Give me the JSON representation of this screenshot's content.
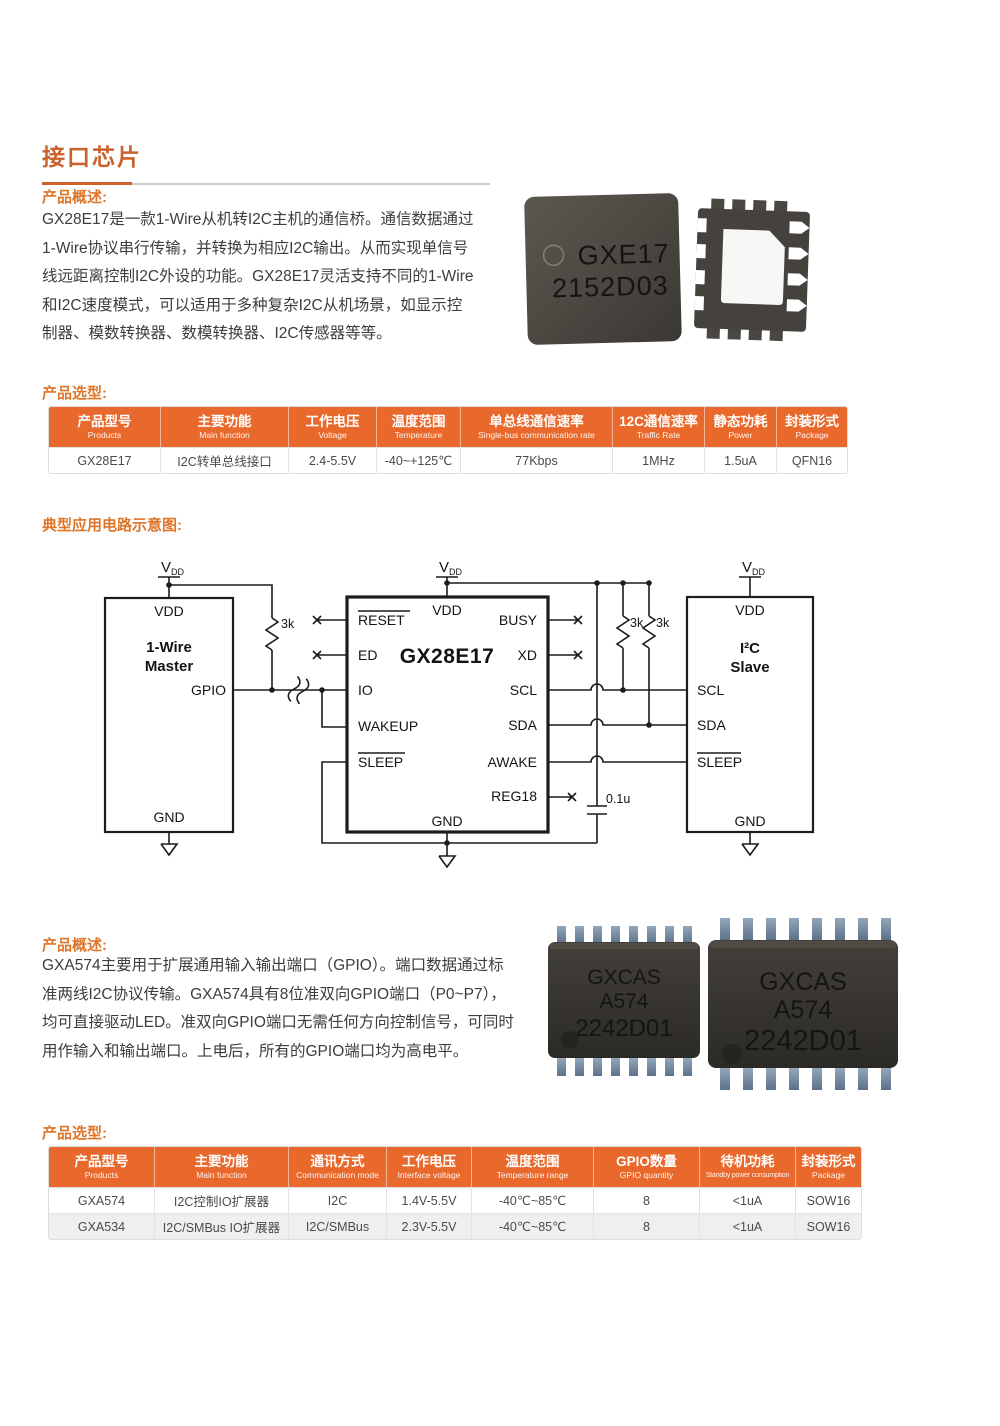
{
  "page": {
    "title": "接口芯片"
  },
  "colors": {
    "accent_orange": "#C9622B",
    "label_orange": "#DE7629",
    "table_header_bg": "#E9682B",
    "alt_row_bg": "#EFEFEF"
  },
  "section1": {
    "overview_label": "产品概述:",
    "overview_text": "GX28E17是一款1-Wire从机转I2C主机的通信桥。通信数据通过\n1-Wire协议串行传输，并转换为相应I2C输出。从而实现单信号\n线远距离控制I2C外设的功能。GX28E17灵活支持不同的1-Wire\n和I2C速度模式，可以适用于多种复杂I2C从机场景，如显示控\n制器、模数转换器、数模转换器、I2C传感器等等。",
    "chip_marking": {
      "line1": "GXE17",
      "line2": "2152D03"
    },
    "selection_label": "产品选型:",
    "table": {
      "columns": [
        {
          "zh": "产品型号",
          "en": "Products"
        },
        {
          "zh": "主要功能",
          "en": "Main function"
        },
        {
          "zh": "工作电压",
          "en": "Voltage"
        },
        {
          "zh": "温度范围",
          "en": "Temperature"
        },
        {
          "zh": "单总线通信速率",
          "en": "Single-bus communication rate"
        },
        {
          "zh": "12C通信速率",
          "en": "Traffic Rate"
        },
        {
          "zh": "静态功耗",
          "en": "Power"
        },
        {
          "zh": "封装形式",
          "en": "Package"
        }
      ],
      "rows": [
        [
          "GX28E17",
          "I2C转单总线接口",
          "2.4-5.5V",
          "-40~+125℃",
          "77Kbps",
          "1MHz",
          "1.5uA",
          "QFN16"
        ]
      ]
    }
  },
  "diagram": {
    "label": "典型应用电路示意图:",
    "supply_v": "V",
    "supply_sub": "DD",
    "master": {
      "name1": "1-Wire",
      "name2": "Master",
      "vdd": "VDD",
      "gpio": "GPIO",
      "gnd": "GND"
    },
    "bridge": {
      "title": "GX28E17",
      "vdd": "VDD",
      "gnd": "GND",
      "reset": "RESET",
      "ed": "ED",
      "io": "IO",
      "wakeup": "WAKEUP",
      "sleep": "SLEEP",
      "busy": "BUSY",
      "xd": "XD",
      "scl": "SCL",
      "sda": "SDA",
      "awake": "AWAKE",
      "reg18": "REG18"
    },
    "slave": {
      "name1": "I²C",
      "name2": "Slave",
      "vdd": "VDD",
      "scl": "SCL",
      "sda": "SDA",
      "sleep": "SLEEP",
      "gnd": "GND"
    },
    "r_pullup_1wire": "3k",
    "r_pullup_scl": "3k",
    "r_pullup_sda": "3k",
    "cap": "0.1u"
  },
  "section2": {
    "overview_label": "产品概述:",
    "overview_text": "GXA574主要用于扩展通用输入输出端口（GPIO）。端口数据通过标\n准两线I2C协议传输。GXA574具有8位准双向GPIO端口（P0~P7），\n均可直接驱动LED。准双向GPIO端口无需任何方向控制信号，可同时\n用作输入和输出端口。上电后，所有的GPIO端口均为高电平。",
    "chip_marking": {
      "line1": "GXCAS",
      "line2": "A574",
      "line3": "2242D01"
    },
    "selection_label": "产品选型:",
    "table": {
      "columns": [
        {
          "zh": "产品型号",
          "en": "Products"
        },
        {
          "zh": "主要功能",
          "en": "Main function"
        },
        {
          "zh": "通讯方式",
          "en": "Communication mode"
        },
        {
          "zh": "工作电压",
          "en": "Interface voltage"
        },
        {
          "zh": "温度范围",
          "en": "Temperature range"
        },
        {
          "zh": "GPIO数量",
          "en": "GPIO quantity"
        },
        {
          "zh": "待机功耗",
          "en": "Standby power consumption"
        },
        {
          "zh": "封装形式",
          "en": "Package"
        }
      ],
      "rows": [
        [
          "GXA574",
          "I2C控制IO扩展器",
          "I2C",
          "1.4V-5.5V",
          "-40℃~85℃",
          "8",
          "<1uA",
          "SOW16"
        ],
        [
          "GXA534",
          "I2C/SMBus IO扩展器",
          "I2C/SMBus",
          "2.3V-5.5V",
          "-40℃~85℃",
          "8",
          "<1uA",
          "SOW16"
        ]
      ]
    }
  }
}
